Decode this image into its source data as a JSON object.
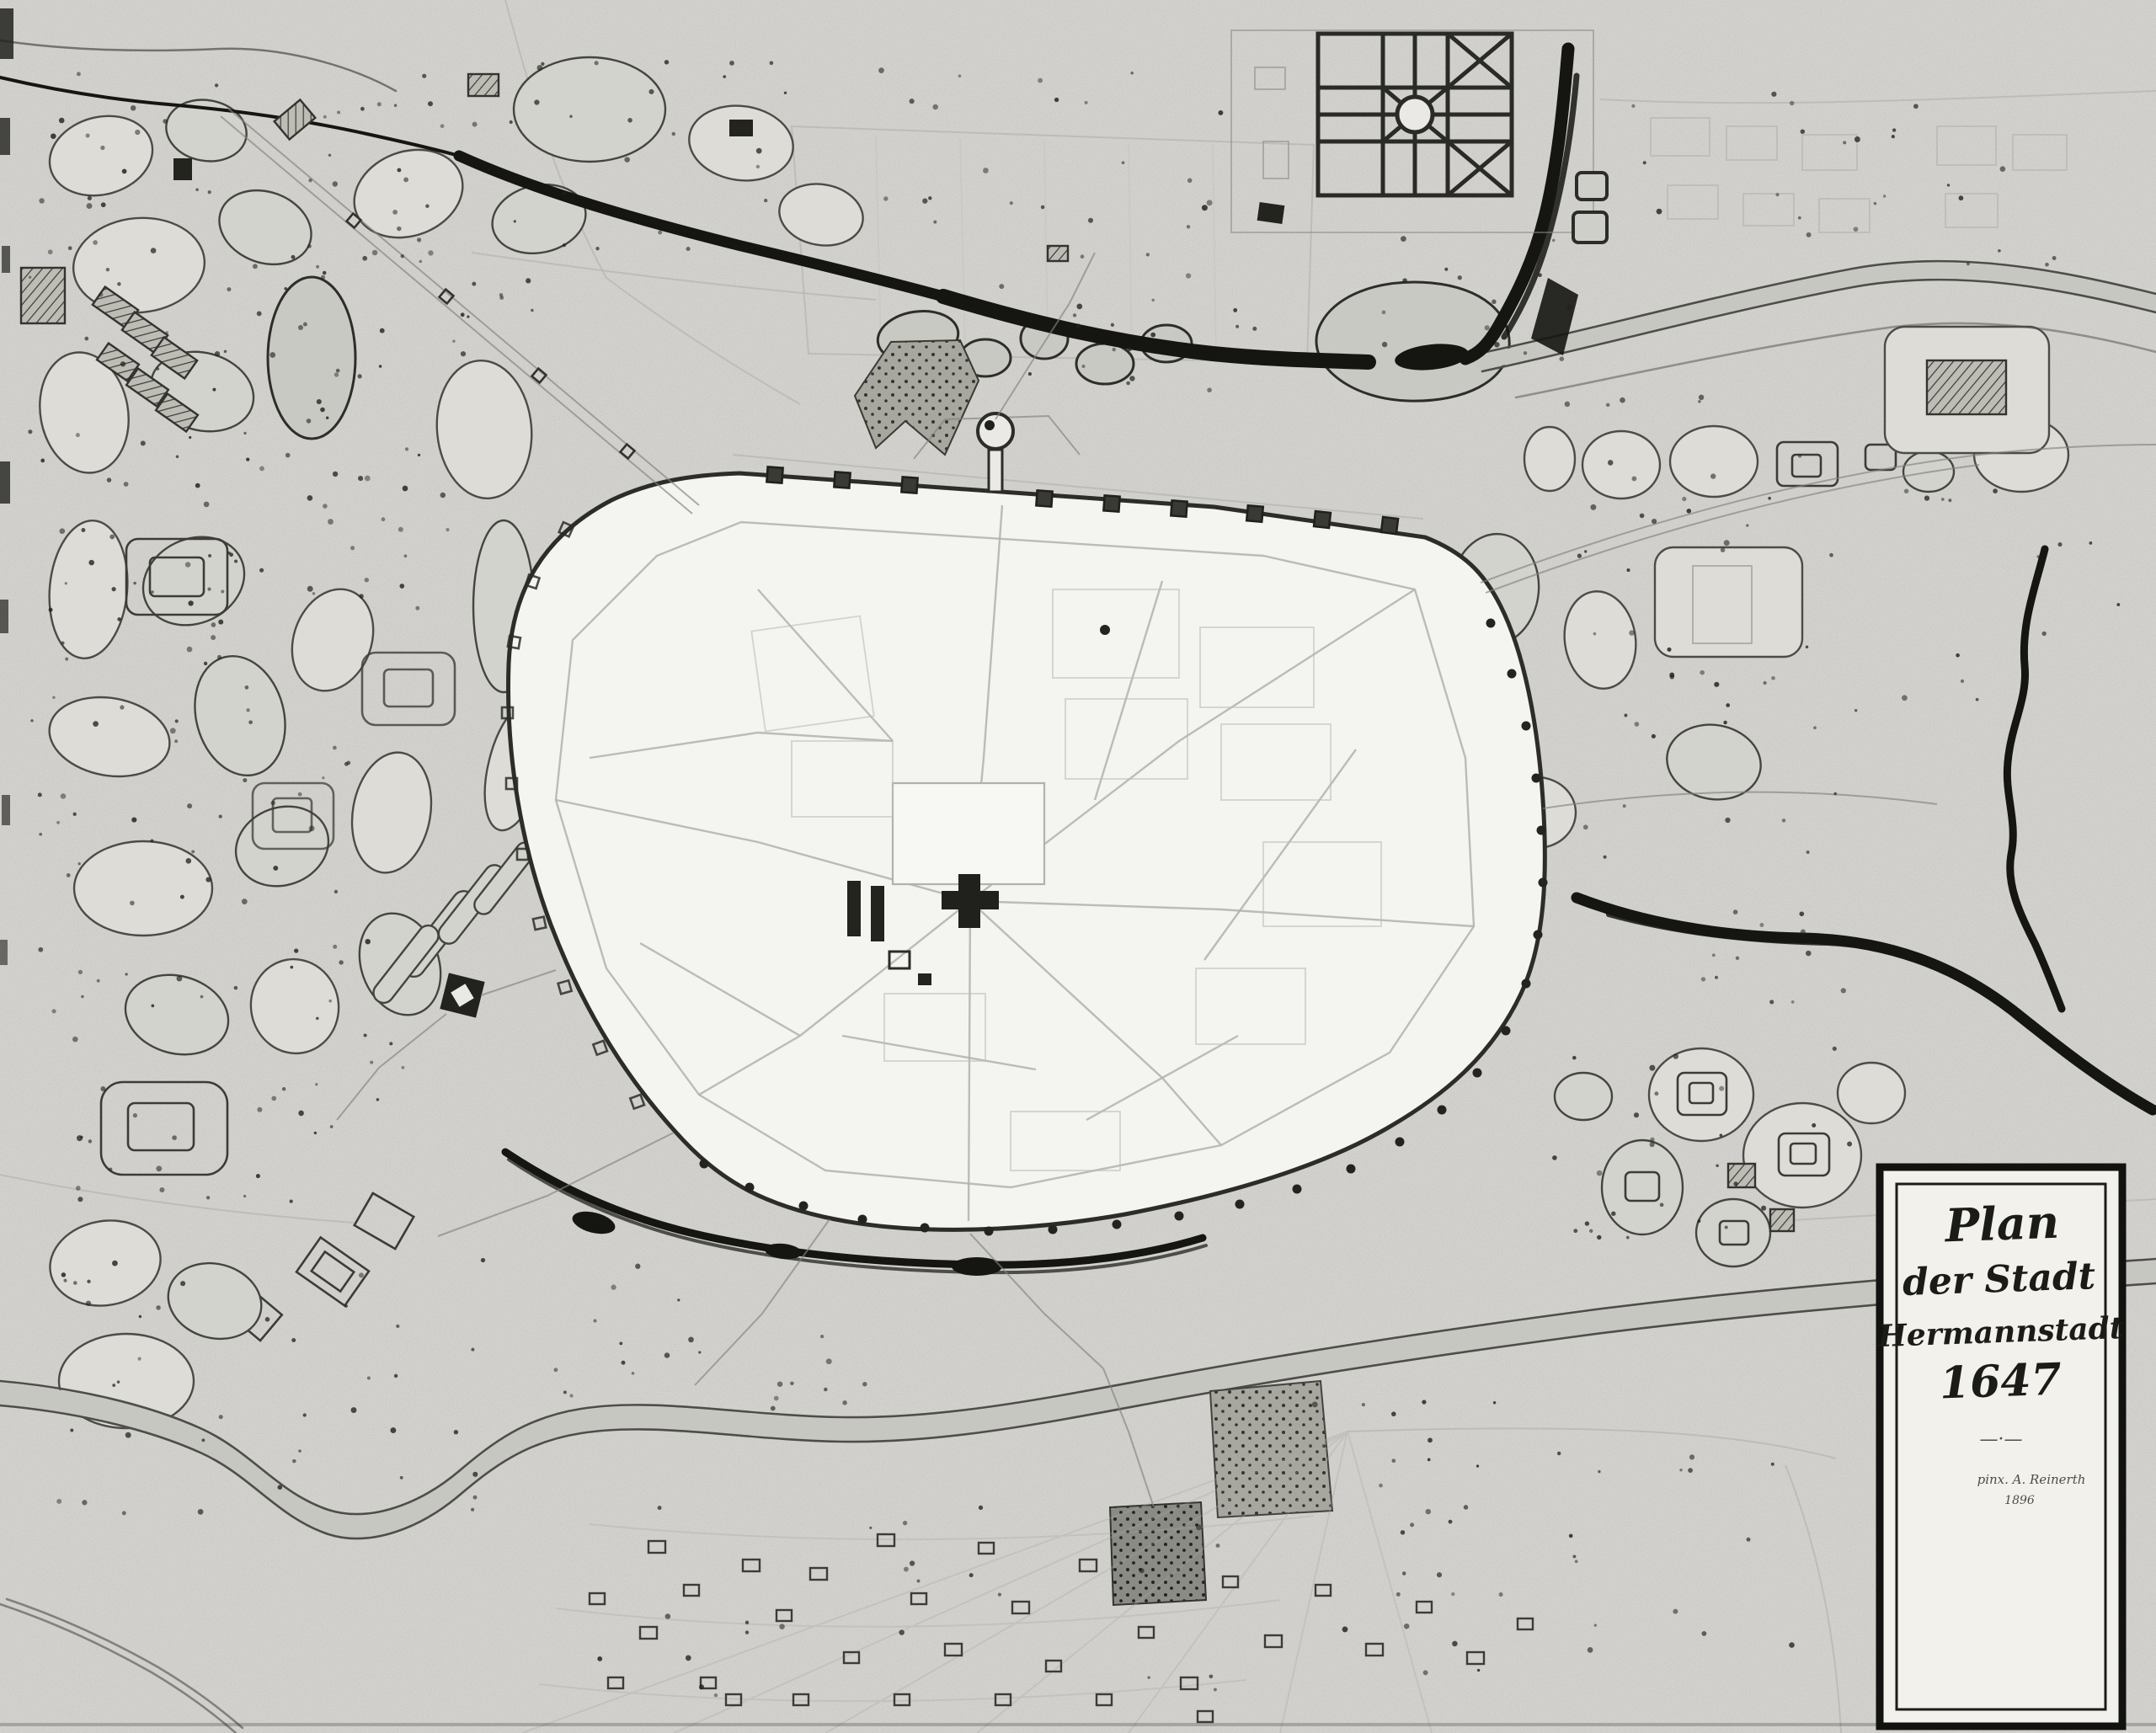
{
  "map": {
    "kind": "historical-town-plan",
    "subject": "Fortified town of Hermannstadt with bastioned wall, suburbs, gardens, rivers and village parcels",
    "year_depicted": "1647"
  },
  "cartouche": {
    "title_line1": "Plan",
    "title_line2": "der Stadt",
    "title_line3": "Hermannstadt",
    "title_line4": "1647",
    "divider": "—·—",
    "signature_line1": "pinx. A. Reinerth",
    "signature_line2": "1896"
  },
  "palette": {
    "paper": "#eae9e5",
    "ink": "#1b1b18",
    "water_dark": "#151512",
    "water_light": "#c7c7c2",
    "plot_fill": "#dddcd7",
    "city_fill": "#f4f4f0",
    "street": "#b2b2ac",
    "shaded_plot": "#9d9d97"
  },
  "features": [
    "walled city with bastion towers",
    "north gate tower",
    "parish church block",
    "south-west fort",
    "upper mill river",
    "formal star garden",
    "lower winding river",
    "suburban garden plots",
    "village parcels with houses",
    "orchard tree dots",
    "title cartouche"
  ]
}
